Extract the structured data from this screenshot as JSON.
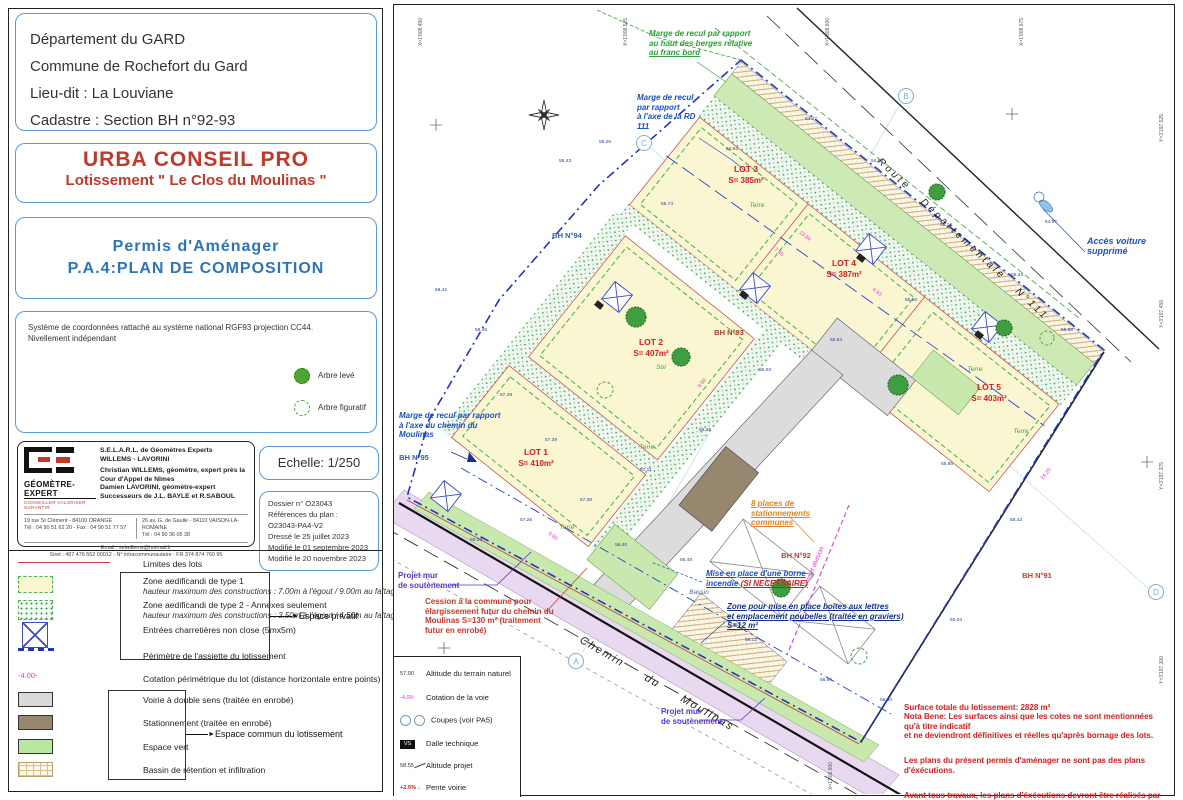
{
  "panel": {
    "location_lines": [
      "Département du GARD",
      "Commune de Rochefort du Gard",
      "Lieu-dit : La Louviane",
      "Cadastre : Section BH n°92-93"
    ],
    "client_title": "URBA CONSEIL PRO",
    "client_subtitle": "Lotissement \" Le Clos du Moulinas \"",
    "permit_line1": "Permis d'Aménager",
    "permit_line2": "P.A.4:PLAN DE COMPOSITION",
    "coord_note1": "Système de coordonnées rattaché au système national RGF93 projection CC44.",
    "coord_note2": "Nivellement indépendant",
    "tree_surveyed": "Arbre levé",
    "tree_figurative": "Arbre figuratif",
    "surveyor": {
      "brand": "GÉOMÈTRE-EXPERT",
      "brand_tagline": "CONSEILLER VALORISER GARANTIR",
      "firm_line1": "S.E.L.A.R.L. de Géomètres Experts",
      "firm_line2": "WILLEMS - LAVORINI",
      "expert1": "Christian WILLEMS, géomètre, expert près la Cour d'Appel de Nîmes",
      "expert2": "Damien LAVORINI, géomètre-expert",
      "successors": "Successeurs de J.L. BAYLE et R.SABOUL",
      "office1_line1": "19 rue St Clément - 84100 ORANGE",
      "office1_line2": "Tél : 04 90 51 62 20 - Fax : 04 90 51 77 57",
      "office2_line1": "26 av. G. de Gaulle - 84110 VAISON-LA-ROMAINE",
      "office2_line2": "Tél : 04 90 36 05 38",
      "email": "Email : selwillems@hotmail.fr",
      "siret": "Siret : 487 476 552 00012 - N° intracommunautaire : FR 374 874 760 95"
    },
    "scale_label": "Echelle: 1/250",
    "dossier_lines": [
      "Dossier n° O23043",
      "Références du plan :",
      "O23043-PA4-V2",
      "Dressé le 25 juillet 2023",
      "Modifié le 01 septembre 2023",
      "Modifié le 20 novembre 2023"
    ]
  },
  "legend": {
    "items": [
      {
        "swatch": "line-red",
        "label": "Limites des lots",
        "sub": ""
      },
      {
        "swatch": "zone1",
        "label": "Zone aedificandi de type 1",
        "sub": "hauteur maximum des constructions : 7.00m à l'égout / 9.00m au faîtage"
      },
      {
        "swatch": "zone2",
        "label": "Zone aedificandi de type 2 - Annexes seulement",
        "sub": "hauteur maximum des constructions : 3.50m à l'égout / 4.50m au faîtage"
      },
      {
        "swatch": "xbox",
        "label": "Entrées charretières non close (5mx5m)",
        "sub": ""
      },
      {
        "swatch": "dash-blue",
        "label": "Périmètre de l'assiette du lotissement",
        "sub": ""
      },
      {
        "swatch": "cotation",
        "swatch_text": "-4.00-",
        "label": "Cotation périmétrique du lot  (distance horizontale entre points)",
        "sub": ""
      },
      {
        "swatch": "voirie",
        "label": "Voirie à double sens (traitée en enrobé)",
        "sub": ""
      },
      {
        "swatch": "stationnement",
        "label": "Stationnement (traitée en enrobé)",
        "sub": ""
      },
      {
        "swatch": "vert",
        "label": "Espace vert",
        "sub": ""
      },
      {
        "swatch": "bassin",
        "label": "Bassin de rétention et infiltration",
        "sub": ""
      }
    ],
    "group_private": "Espace privatif",
    "group_common": "Espace commun du lotissement"
  },
  "plan_legend": {
    "items": [
      {
        "icon": "tn",
        "icon_text": "57.00",
        "label": "Altitude du terrain naturel"
      },
      {
        "icon": "cot",
        "icon_text": "-4.00-",
        "label": "Cotation de la voie"
      },
      {
        "icon": "coupes",
        "icon_text": "",
        "label": "Coupes (voir PA5)"
      },
      {
        "icon": "dalle",
        "icon_text": "VS",
        "label": "Dalle technique"
      },
      {
        "icon": "alt",
        "icon_text": "58.55",
        "label": "Altitude projet"
      },
      {
        "icon": "pente",
        "icon_text": "+2.5%",
        "label": "Pente voirie"
      }
    ]
  },
  "plan": {
    "lots": [
      {
        "name": "LOT 1",
        "area": "S= 410m²",
        "x": 537,
        "y": 455
      },
      {
        "name": "LOT 2",
        "area": "S= 407m²",
        "x": 652,
        "y": 345
      },
      {
        "name": "LOT 3",
        "area": "S= 385m²",
        "x": 747,
        "y": 172
      },
      {
        "name": "LOT 4",
        "area": "S= 387m²",
        "x": 845,
        "y": 266
      },
      {
        "name": "LOT 5",
        "area": "S= 403m²",
        "x": 990,
        "y": 390
      }
    ],
    "parcels": [
      {
        "label": "BH N°94",
        "color": "#2e5fb0",
        "x": 568,
        "y": 238
      },
      {
        "label": "BH N°93",
        "color": "#a33a2a",
        "x": 730,
        "y": 335
      },
      {
        "label": "BH N°95",
        "color": "#2e5fb0",
        "x": 415,
        "y": 460
      },
      {
        "label": "BH N°92",
        "color": "#c23a2a",
        "x": 797,
        "y": 558
      },
      {
        "label": "BH N°91",
        "color": "#c23a2a",
        "x": 1038,
        "y": 578
      }
    ],
    "ground_labels": [
      {
        "t": "Terre",
        "x": 758,
        "y": 207
      },
      {
        "t": "Terre",
        "x": 976,
        "y": 371
      },
      {
        "t": "Terre",
        "x": 1022,
        "y": 433
      },
      {
        "t": "Terre",
        "x": 568,
        "y": 529
      },
      {
        "t": "Terre",
        "x": 648,
        "y": 449
      },
      {
        "t": "Sol",
        "x": 662,
        "y": 369
      },
      {
        "t": "Bassin",
        "x": 700,
        "y": 594
      }
    ],
    "annotations": {
      "berges_a": "Marge de recul par rapport\nau haut des berges relative",
      "berges_b": "au franc bord",
      "marge_rd": "Marge de recul\npar rapport\nà l'axe de la RD\n111",
      "marge_chemin": "Marge de recul par rapport\nà l'axe du chemin du\nMoulinas",
      "acces": "Accès voiture\nsupprimé",
      "borne_text": "Mise en place d'une borne\nincendie ",
      "borne_emph": "(SI NECESSAIRE)",
      "boites": "Zone pour mise en place boîtes aux lettres\net emplacement poubelles (traitée en graviers)\nS=12 m²",
      "parking8": "8 places de\nstationnements\ncommunes",
      "mur": "Projet mur\nde soutènement",
      "cession": "Cession à la commune pour\nélargissement futur du chemin du\nMoulinas  S=130 m² (traitement\nfutur en enrobé)",
      "projet_division": "Projet division",
      "chemin": "Chemin     du     Moulinas",
      "route": "Route   Départementale   N°111"
    },
    "notes": [
      "Surface totale du lotissement: 2828 m²\nNota Bene: Les surfaces ainsi que les cotes ne sont mentionnées qu'à titre indicatif\net ne deviendront définitives et réelles qu'après bornage des lots.",
      "Les plans du présent permis d'aménager ne sont pas des plans d'éxécutions.",
      "Avant tous travaux, les plans d'éxécutions devront être réalisés par l'entreprise."
    ],
    "section_markers": [
      {
        "t": "B",
        "x": 907,
        "y": 96
      },
      {
        "t": "C",
        "x": 645,
        "y": 143
      },
      {
        "t": "A",
        "x": 577,
        "y": 661
      },
      {
        "t": "D",
        "x": 1157,
        "y": 592
      }
    ],
    "spot_elevations": [
      {
        "t": "55.43",
        "x": 560,
        "y": 162
      },
      {
        "t": "55.26",
        "x": 600,
        "y": 143
      },
      {
        "t": "55.74",
        "x": 662,
        "y": 205
      },
      {
        "t": "54.92",
        "x": 727,
        "y": 150
      },
      {
        "t": "54.47",
        "x": 806,
        "y": 120
      },
      {
        "t": "54.66",
        "x": 872,
        "y": 162
      },
      {
        "t": "55.16",
        "x": 941,
        "y": 226
      },
      {
        "t": "55.43",
        "x": 1012,
        "y": 276
      },
      {
        "t": "55.58",
        "x": 1062,
        "y": 331
      },
      {
        "t": "55.50",
        "x": 906,
        "y": 301
      },
      {
        "t": "55.84",
        "x": 831,
        "y": 341
      },
      {
        "t": "56.03",
        "x": 760,
        "y": 371
      },
      {
        "t": "56.46",
        "x": 700,
        "y": 431
      },
      {
        "t": "57.11",
        "x": 641,
        "y": 471
      },
      {
        "t": "57.38",
        "x": 581,
        "y": 501
      },
      {
        "t": "57.26",
        "x": 521,
        "y": 521
      },
      {
        "t": "58.03",
        "x": 471,
        "y": 541
      },
      {
        "t": "56.40",
        "x": 616,
        "y": 546
      },
      {
        "t": "56.48",
        "x": 681,
        "y": 561
      },
      {
        "t": "56.12",
        "x": 746,
        "y": 641
      },
      {
        "t": "55.94",
        "x": 821,
        "y": 681
      },
      {
        "t": "55.60",
        "x": 881,
        "y": 701
      },
      {
        "t": "55.04",
        "x": 951,
        "y": 621
      },
      {
        "t": "55.43",
        "x": 1011,
        "y": 521
      },
      {
        "t": "57.39",
        "x": 546,
        "y": 441
      },
      {
        "t": "57.48",
        "x": 501,
        "y": 396
      },
      {
        "t": "58.46",
        "x": 476,
        "y": 331
      },
      {
        "t": "58.42",
        "x": 436,
        "y": 291
      },
      {
        "t": "55.85",
        "x": 942,
        "y": 465
      },
      {
        "t": "54.97",
        "x": 1046,
        "y": 223
      }
    ],
    "dimensions": [
      {
        "t": "13.84",
        "x": 800,
        "y": 233,
        "r": 38
      },
      {
        "t": "7.95",
        "x": 775,
        "y": 250,
        "r": 38
      },
      {
        "t": "9.00",
        "x": 701,
        "y": 388,
        "r": -52
      },
      {
        "t": "24.20",
        "x": 1044,
        "y": 480,
        "r": -52
      },
      {
        "t": "5.00",
        "x": 549,
        "y": 534,
        "r": 38
      },
      {
        "t": "4.93",
        "x": 873,
        "y": 290,
        "r": 38
      }
    ],
    "grid_labels": [
      {
        "t": "X=1'808.450",
        "x": 423,
        "y": 46,
        "r": -90
      },
      {
        "t": "X=1'808.525",
        "x": 628,
        "y": 46,
        "r": -90
      },
      {
        "t": "X=1'808.600",
        "x": 830,
        "y": 46,
        "r": -90
      },
      {
        "t": "X=1'808.675",
        "x": 1024,
        "y": 46,
        "r": -90
      },
      {
        "t": "Y=3'197.525",
        "x": 1164,
        "y": 142,
        "r": -90
      },
      {
        "t": "Y=3'197.450",
        "x": 1164,
        "y": 328,
        "r": -90
      },
      {
        "t": "Y=3'197.375",
        "x": 1164,
        "y": 490,
        "r": -90
      },
      {
        "t": "Y=3'197.300",
        "x": 1164,
        "y": 684,
        "r": -90
      },
      {
        "t": "X=1'808.600",
        "x": 833,
        "y": 790,
        "r": -90
      }
    ]
  }
}
